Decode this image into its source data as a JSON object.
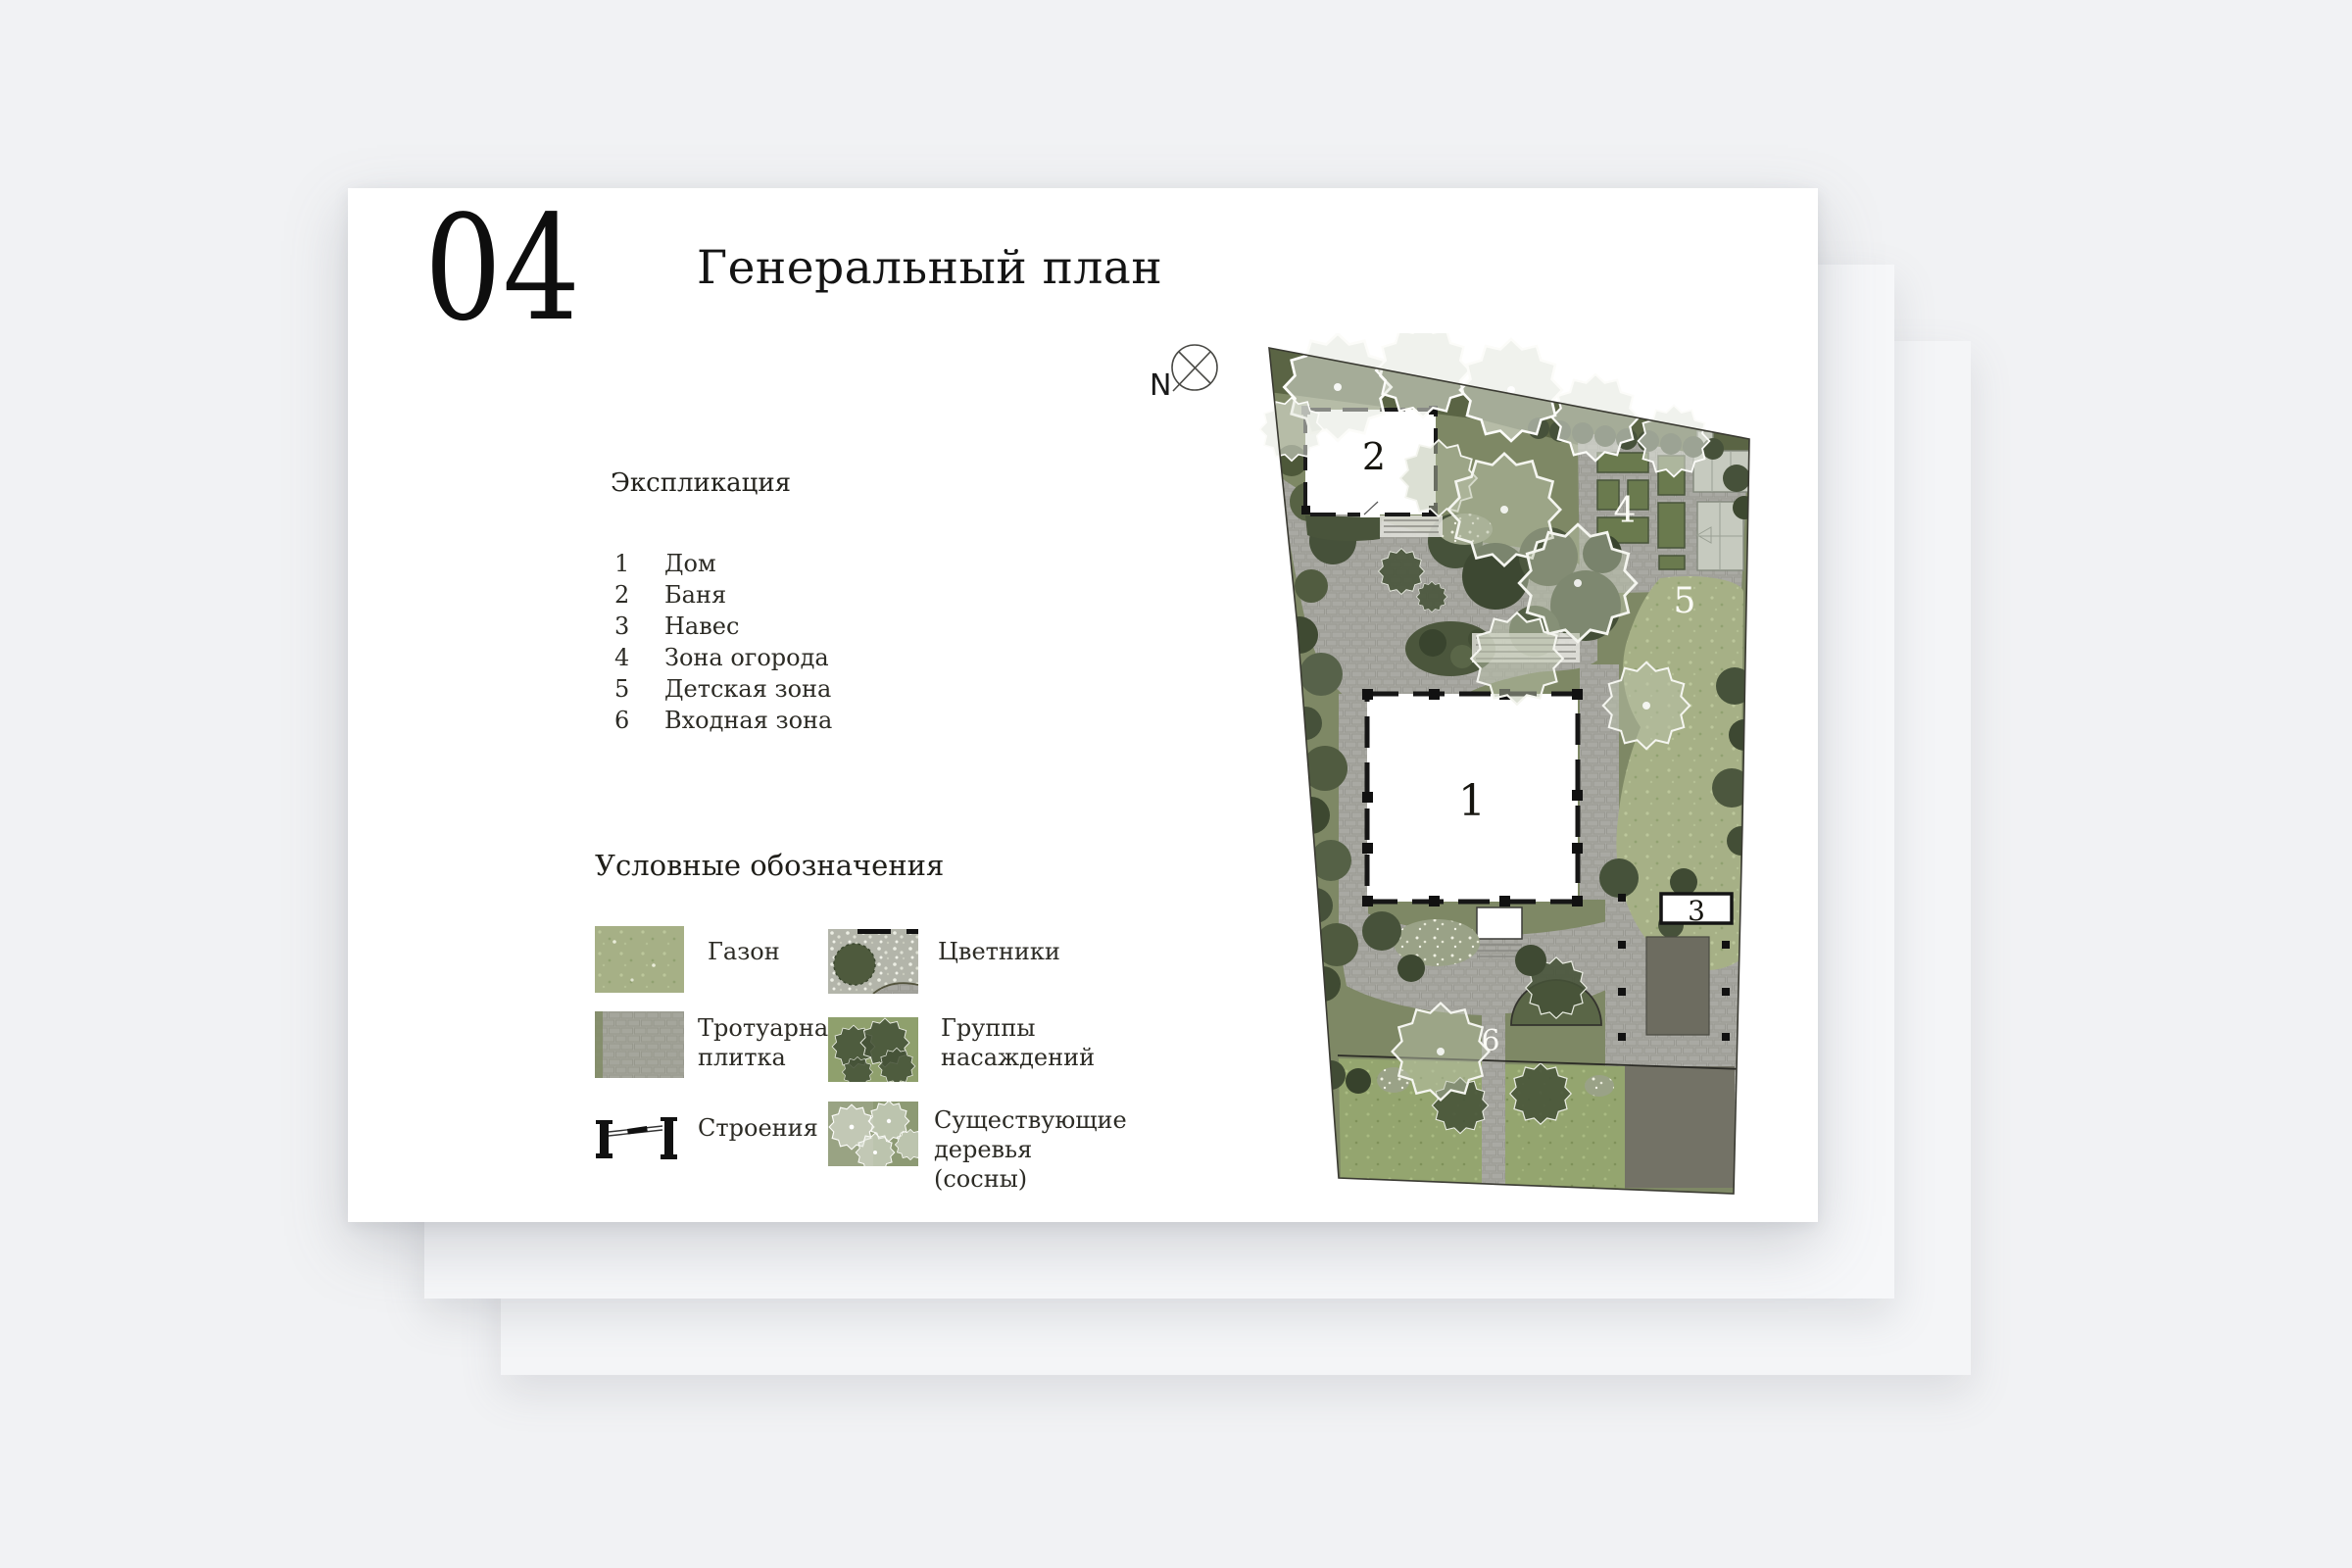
{
  "page": {
    "number": "04",
    "title": "Генеральный план"
  },
  "explication": {
    "heading": "Экспликация",
    "items": [
      {
        "num": "1",
        "label": "Дом"
      },
      {
        "num": "2",
        "label": "Баня"
      },
      {
        "num": "3",
        "label": "Навес"
      },
      {
        "num": "4",
        "label": "Зона огорода"
      },
      {
        "num": "5",
        "label": "Детская зона"
      },
      {
        "num": "6",
        "label": "Входная зона"
      }
    ]
  },
  "legend": {
    "heading": "Условные обозначения",
    "items": [
      {
        "icon": "lawn-swatch",
        "label": "Газон"
      },
      {
        "icon": "flowerbeds-swatch",
        "label": "Цветники"
      },
      {
        "icon": "paving-swatch",
        "label": "Тротуарная плитка"
      },
      {
        "icon": "plantings-swatch",
        "label": "Группы насаждений"
      },
      {
        "icon": "structures-symbol",
        "label": "Строения"
      },
      {
        "icon": "existing-pines-swatch",
        "label": "Существующие деревья (сосны)"
      }
    ]
  },
  "plan": {
    "north_label": "N",
    "markers": {
      "house": "1",
      "bathhouse": "2",
      "canopy": "3",
      "garden": "4",
      "kids": "5",
      "entrance": "6"
    }
  },
  "colors": {
    "canvas_bg": "#f1f2f4",
    "paper": "#ffffff",
    "ink": "#121212",
    "body_text": "#2c2b25",
    "site_green": "#7e8865",
    "planting_dark": "#46523a",
    "lawn": "#a6b086",
    "lawn_bright": "#94a56f",
    "paving": "#a9a9a3",
    "parking": "#6f6e62"
  }
}
